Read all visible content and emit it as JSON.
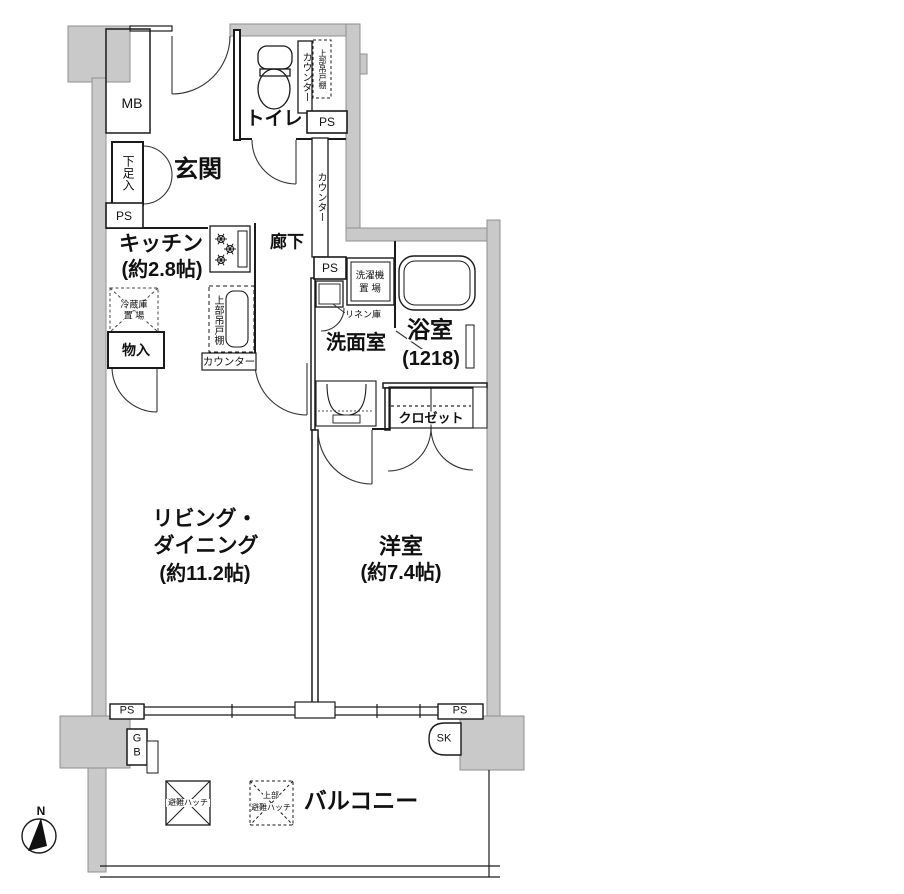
{
  "meta": {
    "type": "apartment-floor-plan"
  },
  "colors": {
    "wall_fill": "#c9c9c9",
    "wall_edge": "#8f8f8f",
    "line": "#1a1a1a",
    "bg": "#ffffff"
  },
  "compass": {
    "north": "N"
  },
  "labels": {
    "ps": "PS",
    "mb": "MB",
    "sk": "SK",
    "gb_top": "G",
    "gb_bottom": "B"
  },
  "rooms": {
    "entrance": "玄関",
    "shoe_cabinet": "下足入",
    "toilet": "トイレ",
    "counter": "カウンター",
    "upper_cabinet": "上部吊戸棚",
    "kitchen": "キッチン",
    "kitchen_size": "(約2.8帖)",
    "fridge_line1": "冷蔵庫",
    "fridge_line2": "置 場",
    "storage": "物入",
    "hallway": "廊下",
    "washroom": "洗面室",
    "washer_line1": "洗濯機",
    "washer_line2": "置 場",
    "linen": "リネン庫",
    "bath": "浴室",
    "bath_size": "(1218)",
    "closet": "クロゼット",
    "living_line1": "リビング・",
    "living_line2": "ダイニング",
    "living_size": "(約11.2帖)",
    "bedroom": "洋室",
    "bedroom_size": "(約7.4帖)",
    "balcony": "バルコニー",
    "hatch": "避難ハッチ",
    "upper_hatch_line1": "上部",
    "upper_hatch_line2": "避難ハッチ"
  }
}
